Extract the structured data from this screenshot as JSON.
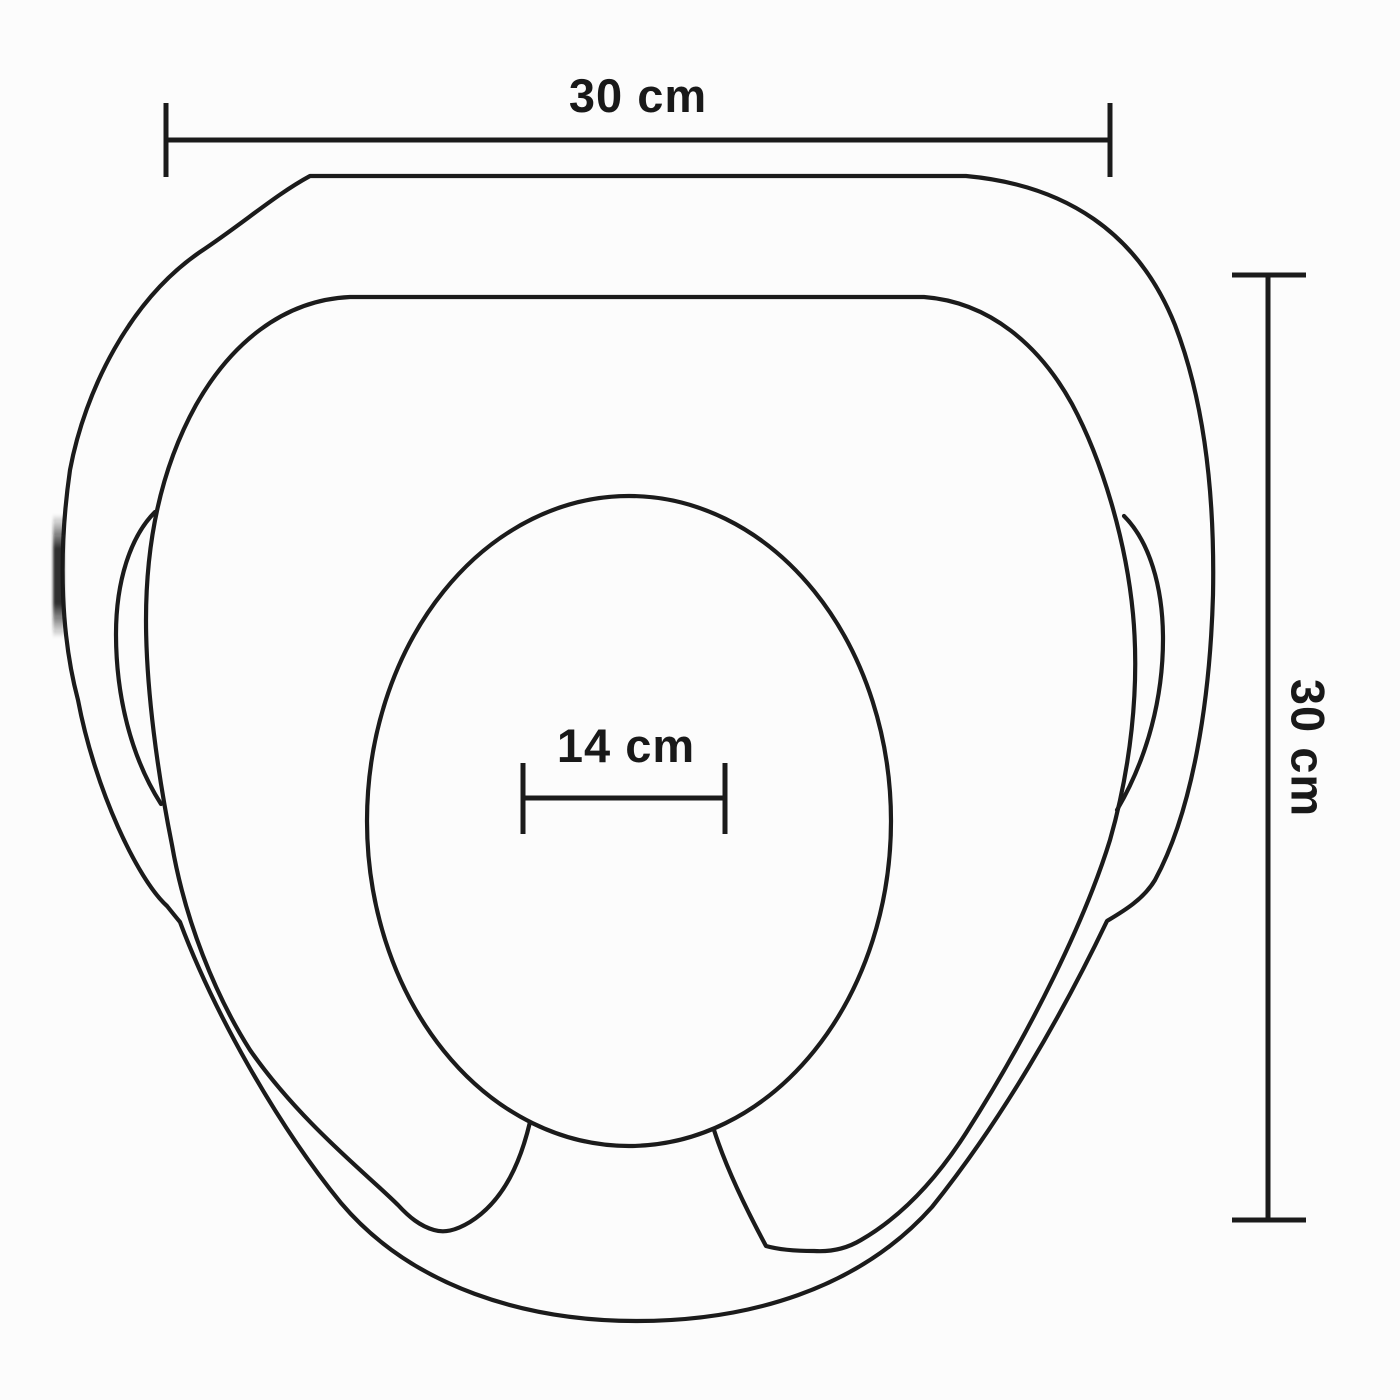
{
  "page": {
    "background_color": "#fcfcfc"
  },
  "drawing": {
    "shape_name": "toilet-training-seat-top-view",
    "line_color": "#1b1b1b",
    "text_color": "#191919",
    "measurements": {
      "overall_width": "30 cm",
      "overall_depth": "30 cm",
      "opening_width": "14 cm"
    }
  }
}
